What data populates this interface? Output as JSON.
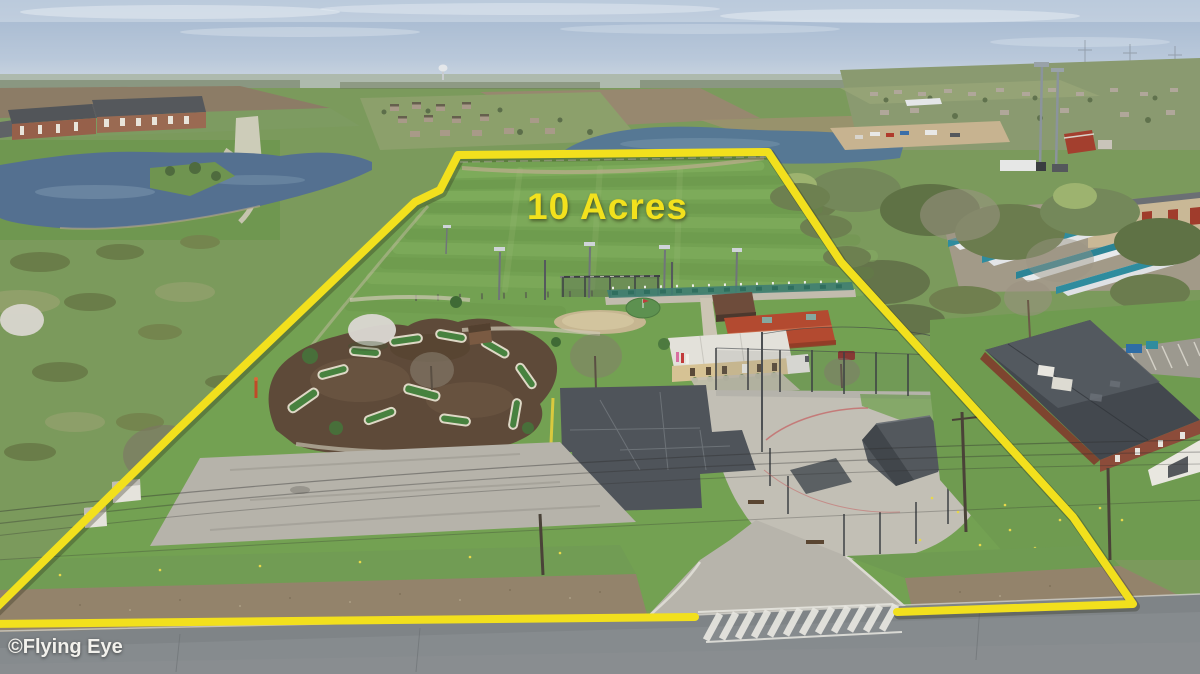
{
  "overlay": {
    "acreage_label": "10 Acres",
    "watermark": "©Flying Eye",
    "label_color": "#F2E11D",
    "boundary": {
      "color": "#F2E01D",
      "stroke_width": "8",
      "main_points": "-12,616 175,432 415,202 440,190 458,155 768,152 841,262 1073,517 1133,604 897,612",
      "bottom_segment_points": "695,617 -12,624"
    }
  },
  "scene": {
    "type": "aerial-drone-photo",
    "palette": {
      "sky": "#A9BCD3",
      "field_green": "#73A152",
      "pond_blue": "#547090",
      "red_roof": "#B34A30",
      "dark_roof": "#43484E",
      "storage_teal": "#2F8C9E",
      "mulch_brown": "#5E4A39",
      "asphalt": "#4F545A",
      "concrete": "#B6B3AA",
      "road": "#7F8487",
      "gravel": "#93836B"
    },
    "features": [
      "driving-range-field",
      "tee-line",
      "practice-net",
      "putting-green",
      "mini-golf-course",
      "clubhouse-red-roof",
      "clubhouse-tan-building",
      "batting-cages",
      "parking-lot",
      "driveway-crosswalk",
      "left-pond",
      "north-pond",
      "apartment-complex",
      "storage-units",
      "brick-building",
      "road",
      "power-lines",
      "water-tower"
    ]
  }
}
